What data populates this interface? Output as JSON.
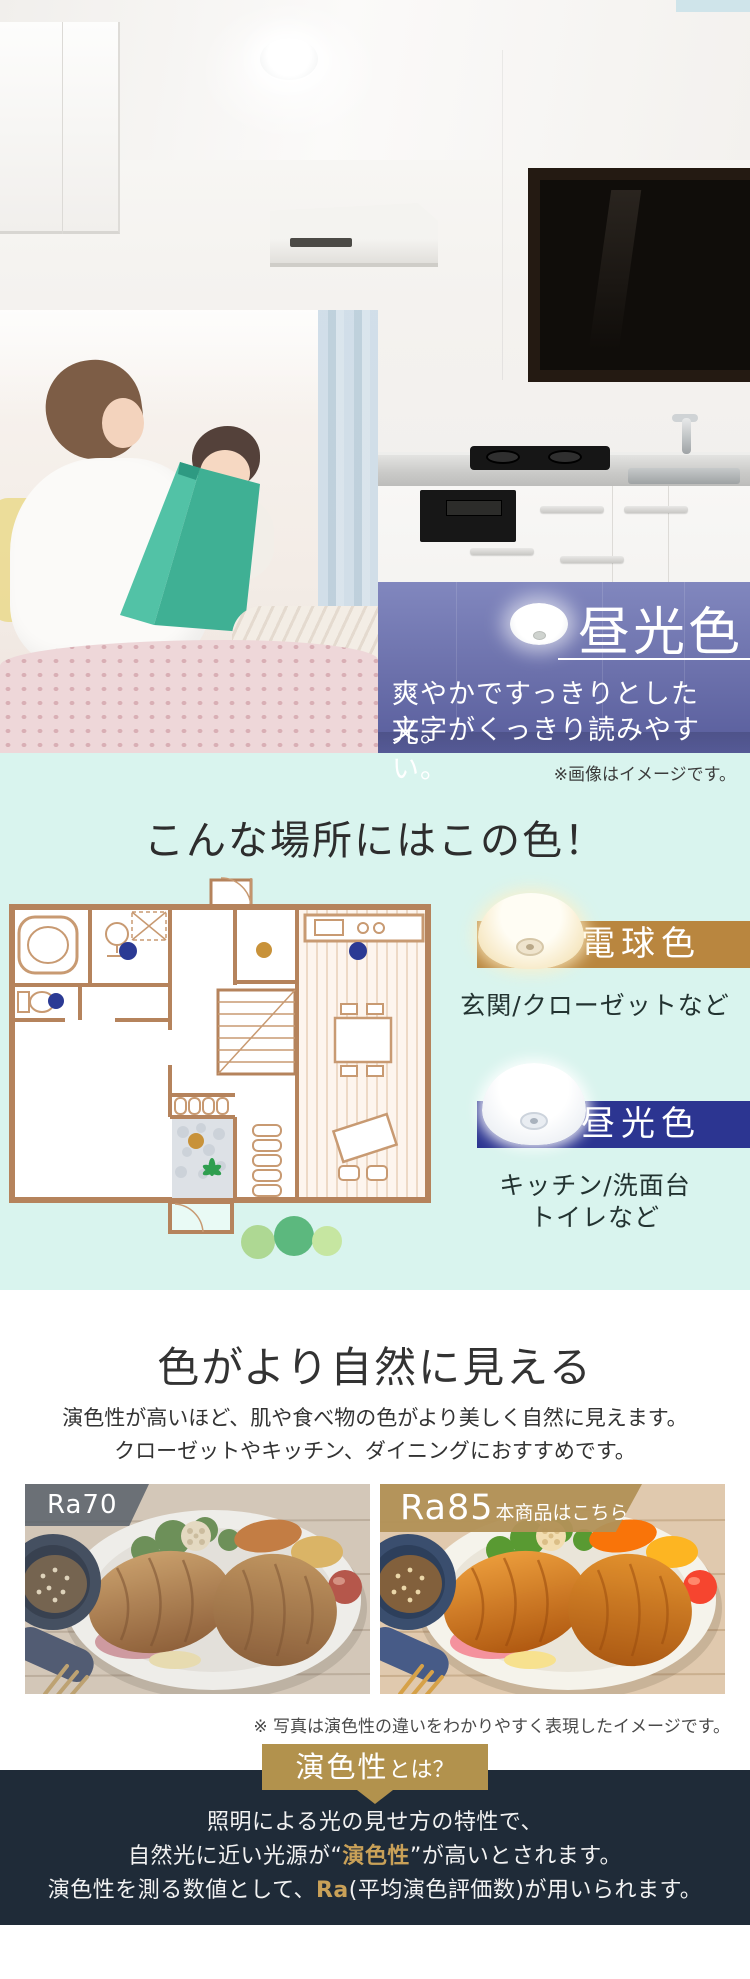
{
  "hero": {
    "label": "昼光色",
    "desc_line1": "爽やかですっきりとした光。",
    "desc_line2": "文字がくっきり読みやすい。",
    "note": "※画像はイメージです。"
  },
  "placement": {
    "heading": "こんな場所にはこの色！",
    "warm": {
      "label": "電球色",
      "caption": "玄関/クローゼットなど"
    },
    "cool": {
      "label": "昼光色",
      "caption_line1": "キッチン/洗面台",
      "caption_line2": "トイレなど"
    }
  },
  "rendering": {
    "heading": "色がより自然に見える",
    "desc_line1": "演色性が高いほど、肌や食べ物の色がより美しく自然に見えます。",
    "desc_line2": "クローゼットやキッチン、ダイニングにおすすめです。",
    "left_label": "Ra70",
    "right_label": "Ra85",
    "right_sublabel": "本商品はこちら",
    "note": "※ 写真は演色性の違いをわかりやすく表現したイメージです。"
  },
  "glossary": {
    "badge_main": "演色性",
    "badge_sub": "とは？",
    "line1": "照明による光の見せ方の特性で、",
    "line2_pre": "自然光に近い光源が“",
    "line2_em": "演色性",
    "line2_post": "”が高いとされます。",
    "line3_pre": "演色性を測る数値として、",
    "line3_em": "Ra",
    "line3_post": "(平均演色評価数)が用いられます。"
  },
  "colors": {
    "mint_bg": "#d9f4ee",
    "hero_band_purple": "#6b70ab",
    "warm_band_gold": "#b9863f",
    "cool_band_navy": "#2c3591",
    "footer_bg": "#1f2b38",
    "gold_accent": "#c9a158",
    "badge_gold": "#b2924d",
    "ra70_gray": "#5c646c",
    "floorplan_line": "#b5835c",
    "dot_daylight": "#2b3a94",
    "dot_bulb": "#c8923a"
  }
}
